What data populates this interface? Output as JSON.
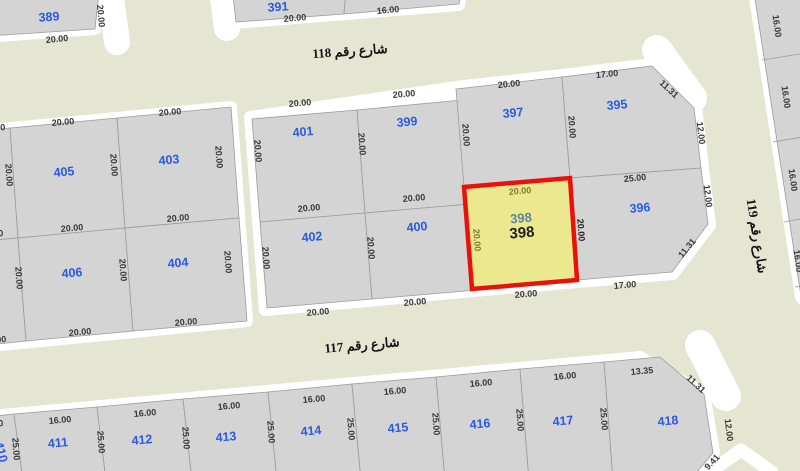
{
  "map": {
    "colors": {
      "street": "#e4e6d1",
      "road_edge": "#ffffff",
      "parcel": "#d4d4d4",
      "parcel_stroke": "#9b9b9b",
      "highlight_fill": "#ece88f",
      "highlight_stroke": "#e9120b",
      "number_blue": "#2b5adb",
      "teal": "#5d87a0",
      "dim": "#383838",
      "olive": "#7e7b2e",
      "dark": "#1f1f1f",
      "street_text": "#141414"
    },
    "stubs": [
      {
        "pts": "110,-10 117,42",
        "w": 26
      },
      {
        "pts": "222,-10 227,28",
        "w": 26
      },
      {
        "pts": "657,50 692,98",
        "w": 30
      },
      {
        "pts": "700,345 726,396",
        "w": 30
      },
      {
        "pts": "707,474 741,450 772,472",
        "w": 13
      }
    ],
    "pads": [
      "-16,-12 99,-9 95,29 -16,37",
      "230,-16 466,-36 459,5 234,23",
      "753,-16 832,-16 832,332 801,297",
      "-20,131 231,107 247,321 -20,347",
      "250,117 456,87 562,75 652,64 696,106 703,168 710,225 673,274 578,282 473,291 368,301 265,310",
      "-20,417 640,357 704,393 714,452 694,480 -20,480"
    ],
    "parcels": [
      {
        "id": "389",
        "pts": "-12,-10 99,-8 95,29 -12,36",
        "lx": 49,
        "ly": 17,
        "lr": -4
      },
      {
        "id": "391",
        "pts": "232,-14 347,-24 344,14 236,22",
        "lx": 278,
        "ly": 7,
        "lr": -4
      },
      {
        "id": "",
        "pts": "347,-24 465,-34 459,4 344,14"
      },
      {
        "id": "",
        "pts": "753,-14 828,-14 828,330 801,296"
      },
      {
        "id": "",
        "pts": "-40,133 10,128 18,238 -40,243"
      },
      {
        "id": "",
        "pts": "-40,243 18,238 26,341 -40,348"
      },
      {
        "id": "405",
        "pts": "10,128 117,118 125,228 18,238",
        "lx": 64,
        "ly": 172
      },
      {
        "id": "403",
        "pts": "117,118 231,107 239,218 125,228",
        "lx": 169,
        "ly": 160
      },
      {
        "id": "406",
        "pts": "18,238 125,228 133,331 26,341",
        "lx": 72,
        "ly": 273
      },
      {
        "id": "404",
        "pts": "125,228 239,218 247,321 133,331",
        "lx": 178,
        "ly": 263
      },
      {
        "id": "401",
        "pts": "252,119 357,110 365,213 260,222",
        "lx": 303,
        "ly": 132
      },
      {
        "id": "399",
        "pts": "357,110 462,100 470,204 365,213",
        "lx": 407,
        "ly": 122
      },
      {
        "id": "402",
        "pts": "260,222 365,213 372,299 267,308",
        "lx": 312,
        "ly": 237
      },
      {
        "id": "400",
        "pts": "365,213 470,204 477,290 372,299",
        "lx": 417,
        "ly": 227
      },
      {
        "id": "397",
        "pts": "456,89 562,77 570,178 464,187",
        "lx": 513,
        "ly": 113
      },
      {
        "id": "395",
        "pts": "562,77 652,66 694,108 701,168 570,178",
        "lx": 617,
        "ly": 105
      },
      {
        "id": "396",
        "pts": "570,178 701,168 708,224 672,272 577,280",
        "lx": 640,
        "ly": 208
      },
      {
        "id": "410",
        "pts": "-40,420 14,414 23,480 -40,480",
        "lx": 1,
        "ly": 452,
        "lr": 75
      },
      {
        "id": "411",
        "pts": "14,414 97,407 106,480 23,480",
        "lx": 58,
        "ly": 443
      },
      {
        "id": "412",
        "pts": "97,407 183,399 192,480 106,480",
        "lx": 142,
        "ly": 440
      },
      {
        "id": "413",
        "pts": "183,399 268,392 277,480 192,480",
        "lx": 226,
        "ly": 437
      },
      {
        "id": "414",
        "pts": "268,392 352,384 361,480 277,480",
        "lx": 311,
        "ly": 431
      },
      {
        "id": "415",
        "pts": "352,384 436,377 445,480 361,480",
        "lx": 398,
        "ly": 428
      },
      {
        "id": "416",
        "pts": "436,377 520,369 529,480 445,480",
        "lx": 480,
        "ly": 424
      },
      {
        "id": "417",
        "pts": "520,369 604,362 613,480 529,480",
        "lx": 563,
        "ly": 421
      },
      {
        "id": "418",
        "pts": "604,362 660,357 704,394 713,453 690,480 613,480",
        "lx": 668,
        "ly": 421
      }
    ],
    "dividers": [
      "762,60 832,49",
      "773,142 832,132",
      "784,222 832,213",
      "795,287 832,279"
    ],
    "highlight": {
      "id": "398",
      "pts": "464,187 570,178 577,280 472,289",
      "labels": [
        {
          "t": "398",
          "x": 521,
          "y": 218,
          "c": "teal",
          "fs": 13
        },
        {
          "t": "398",
          "x": 522,
          "y": 233,
          "c": "dark",
          "fs": 15
        }
      ]
    },
    "dims": [
      {
        "t": "20.00",
        "x": 101,
        "y": 16,
        "r": 85
      },
      {
        "t": "20.00",
        "x": 57,
        "y": 39,
        "r": -6
      },
      {
        "t": "20.00",
        "x": 295,
        "y": 18,
        "r": -5
      },
      {
        "t": "16.00",
        "x": 388,
        "y": 10,
        "r": -5
      },
      {
        "t": "16.00",
        "x": 777,
        "y": 26,
        "r": 82
      },
      {
        "t": "16.00",
        "x": 786,
        "y": 97,
        "r": 82
      },
      {
        "t": "16.00",
        "x": 793,
        "y": 180,
        "r": 82
      },
      {
        "t": "16.00",
        "x": 798,
        "y": 261,
        "r": 82
      },
      {
        "t": "20.00",
        "x": -6,
        "y": 128,
        "r": -5
      },
      {
        "t": "20.00",
        "x": 63,
        "y": 122,
        "r": -5
      },
      {
        "t": "20.00",
        "x": 170,
        "y": 112,
        "r": -5
      },
      {
        "t": "20.00",
        "x": 9,
        "y": 175,
        "r": 86
      },
      {
        "t": "20.00",
        "x": 114,
        "y": 165,
        "r": 86
      },
      {
        "t": "20.00",
        "x": 219,
        "y": 157,
        "r": 86
      },
      {
        "t": "20.00",
        "x": 72,
        "y": 228,
        "r": -5
      },
      {
        "t": "20.00",
        "x": 178,
        "y": 218,
        "r": -5
      },
      {
        "t": "20.00",
        "x": -8,
        "y": 234,
        "r": -5
      },
      {
        "t": "20.00",
        "x": 19,
        "y": 278,
        "r": 86
      },
      {
        "t": "20.00",
        "x": 123,
        "y": 270,
        "r": 86
      },
      {
        "t": "20.00",
        "x": 228,
        "y": 262,
        "r": 86
      },
      {
        "t": "20.00",
        "x": 80,
        "y": 332,
        "r": -5
      },
      {
        "t": "20.00",
        "x": 186,
        "y": 322,
        "r": -5
      },
      {
        "t": "17.00",
        "x": -5,
        "y": 340,
        "r": -5
      },
      {
        "t": "20.00",
        "x": 300,
        "y": 103,
        "r": -5
      },
      {
        "t": "20.00",
        "x": 404,
        "y": 94,
        "r": -5
      },
      {
        "t": "20.00",
        "x": 258,
        "y": 151,
        "r": 86
      },
      {
        "t": "20.00",
        "x": 362,
        "y": 144,
        "r": 86
      },
      {
        "t": "20.00",
        "x": 466,
        "y": 135,
        "r": 86
      },
      {
        "t": "20.00",
        "x": 309,
        "y": 208,
        "r": -5
      },
      {
        "t": "20.00",
        "x": 414,
        "y": 198,
        "r": -5
      },
      {
        "t": "20.00",
        "x": 266,
        "y": 258,
        "r": 86
      },
      {
        "t": "20.00",
        "x": 371,
        "y": 248,
        "r": 86
      },
      {
        "t": "20.00",
        "x": 318,
        "y": 312,
        "r": -5
      },
      {
        "t": "20.00",
        "x": 415,
        "y": 302,
        "r": -5
      },
      {
        "t": "20.00",
        "x": 509,
        "y": 84,
        "r": -6
      },
      {
        "t": "17.00",
        "x": 607,
        "y": 74,
        "r": -6
      },
      {
        "t": "11.31",
        "x": 669,
        "y": 89,
        "r": 43
      },
      {
        "t": "20.00",
        "x": 572,
        "y": 127,
        "r": 86
      },
      {
        "t": "12.00",
        "x": 701,
        "y": 133,
        "r": 83
      },
      {
        "t": "25.00",
        "x": 635,
        "y": 178,
        "r": -6
      },
      {
        "t": "12.00",
        "x": 708,
        "y": 196,
        "r": 83
      },
      {
        "t": "11.31",
        "x": 687,
        "y": 248,
        "r": -50
      },
      {
        "t": "20.00",
        "x": 526,
        "y": 294,
        "r": -5
      },
      {
        "t": "17.00",
        "x": 625,
        "y": 285,
        "r": -5
      },
      {
        "t": "20.00",
        "x": 520,
        "y": 191,
        "r": -5,
        "c": "olive"
      },
      {
        "t": "20.00",
        "x": 477,
        "y": 240,
        "r": 86,
        "c": "olive"
      },
      {
        "t": "20.00",
        "x": 581,
        "y": 230,
        "r": 86,
        "c": "dark"
      },
      {
        "t": "16.00",
        "x": -8,
        "y": 424,
        "r": -5
      },
      {
        "t": "16.00",
        "x": 60,
        "y": 420,
        "r": -5
      },
      {
        "t": "16.00",
        "x": 145,
        "y": 413,
        "r": -5
      },
      {
        "t": "16.00",
        "x": 229,
        "y": 406,
        "r": -5
      },
      {
        "t": "16.00",
        "x": 314,
        "y": 399,
        "r": -5
      },
      {
        "t": "16.00",
        "x": 395,
        "y": 391,
        "r": -5
      },
      {
        "t": "16.00",
        "x": 481,
        "y": 383,
        "r": -5
      },
      {
        "t": "16.00",
        "x": 565,
        "y": 376,
        "r": -5
      },
      {
        "t": "13.35",
        "x": 642,
        "y": 371,
        "r": -5
      },
      {
        "t": "11.31",
        "x": 696,
        "y": 384,
        "r": 43
      },
      {
        "t": "12.00",
        "x": 729,
        "y": 430,
        "r": 83
      },
      {
        "t": "9.41",
        "x": 712,
        "y": 462,
        "r": -46
      },
      {
        "t": "25.00",
        "x": 16,
        "y": 449,
        "r": 86
      },
      {
        "t": "25.00",
        "x": 101,
        "y": 442,
        "r": 86
      },
      {
        "t": "25.00",
        "x": 186,
        "y": 438,
        "r": 86
      },
      {
        "t": "25.00",
        "x": 271,
        "y": 432,
        "r": 86
      },
      {
        "t": "25.00",
        "x": 351,
        "y": 429,
        "r": 86
      },
      {
        "t": "25.00",
        "x": 436,
        "y": 424,
        "r": 86
      },
      {
        "t": "25.00",
        "x": 520,
        "y": 420,
        "r": 86
      },
      {
        "t": "25.00",
        "x": 604,
        "y": 419,
        "r": 86
      }
    ],
    "streets": [
      {
        "id": "118",
        "name": "شارع رقم 118",
        "x": 350,
        "y": 51,
        "r": -4
      },
      {
        "id": "117",
        "name": "شارع رقم 117",
        "x": 362,
        "y": 345,
        "r": -5
      },
      {
        "id": "119",
        "name": "شارع رقم 119",
        "x": 757,
        "y": 236,
        "r": 81
      }
    ]
  }
}
